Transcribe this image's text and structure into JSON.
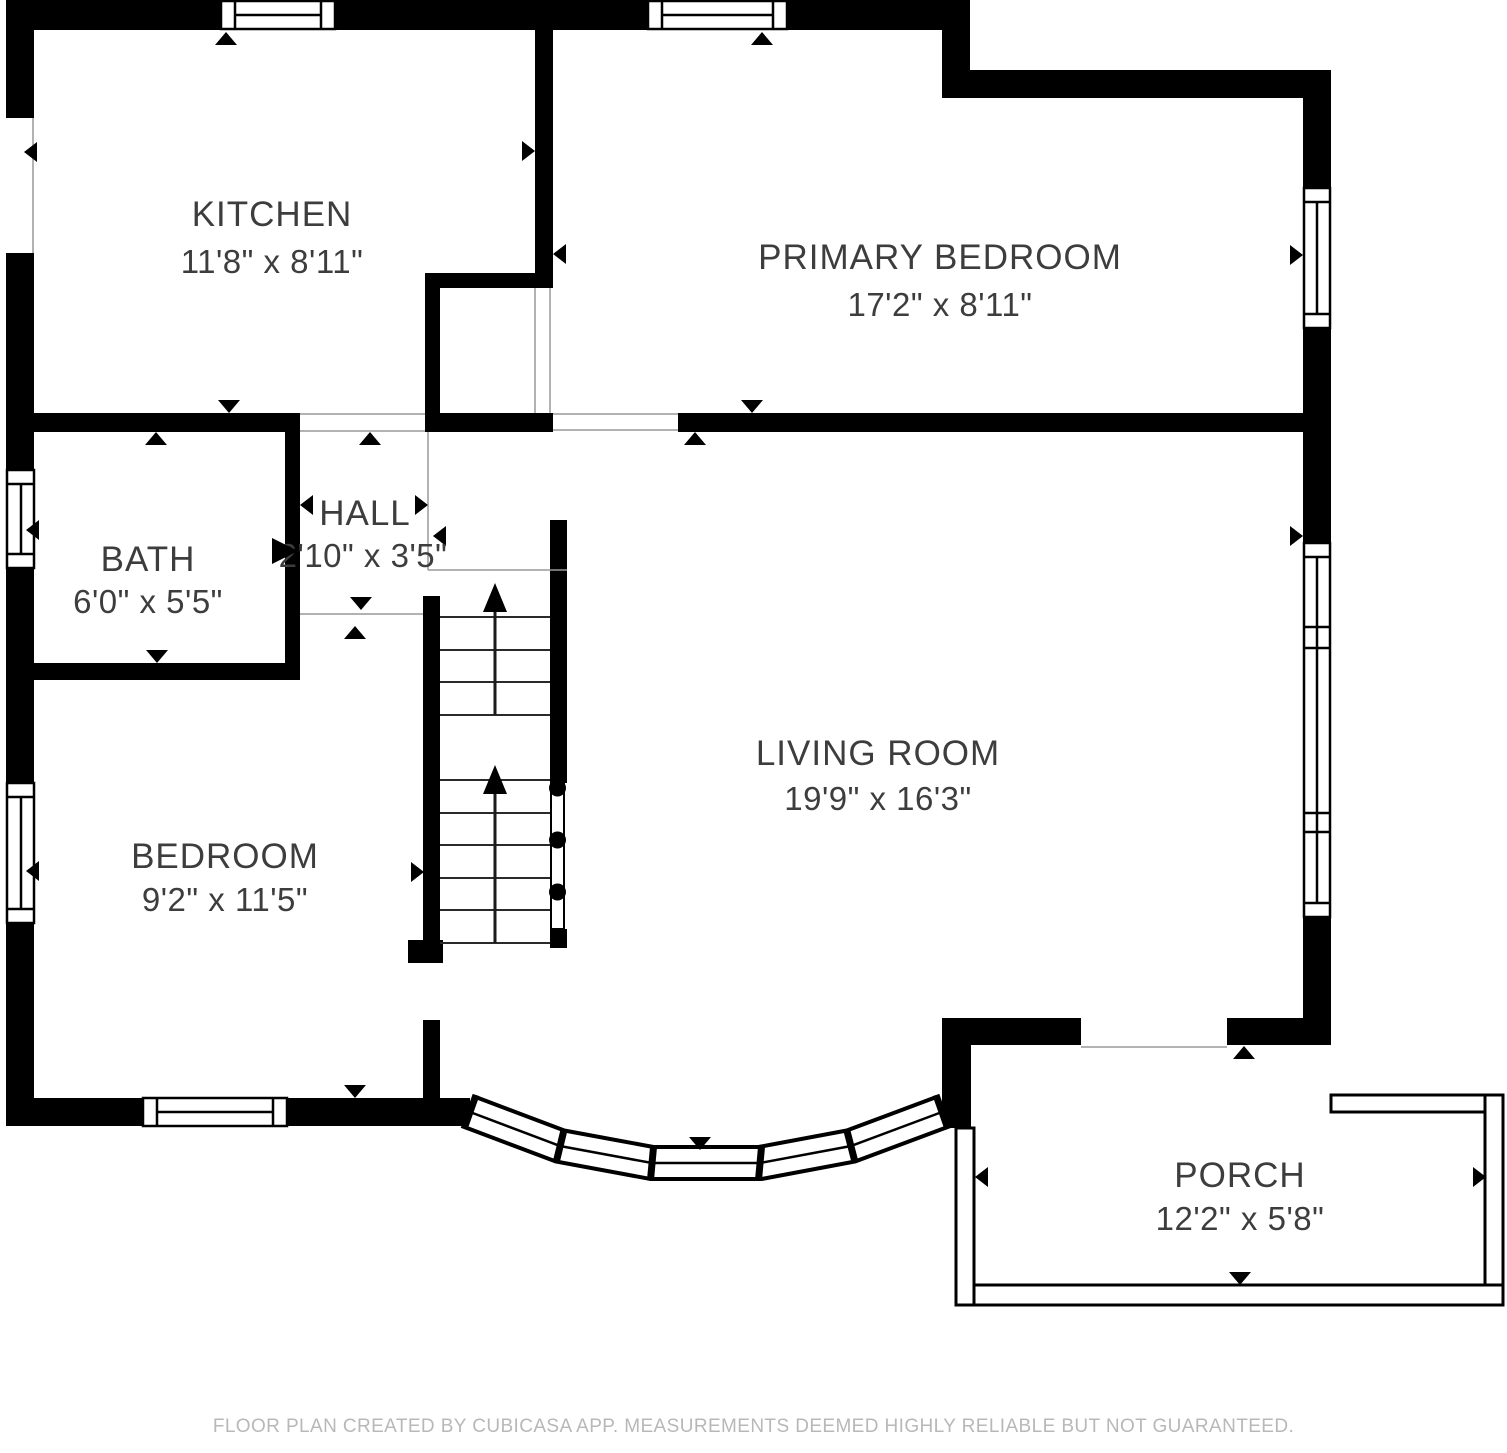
{
  "plan": {
    "rooms": [
      {
        "name": "KITCHEN",
        "dimensions": "11'8\" x 8'11\""
      },
      {
        "name": "PRIMARY BEDROOM",
        "dimensions": "17'2\" x 8'11\""
      },
      {
        "name": "HALL",
        "dimensions": "2'10\" x 3'5\""
      },
      {
        "name": "BATH",
        "dimensions": "6'0\" x 5'5\""
      },
      {
        "name": "BEDROOM",
        "dimensions": "9'2\" x 11'5\""
      },
      {
        "name": "LIVING ROOM",
        "dimensions": "19'9\" x 16'3\""
      },
      {
        "name": "PORCH",
        "dimensions": "12'2\" x 5'8\""
      }
    ],
    "features": [
      "staircase-up",
      "bay-window",
      "porch-railing",
      "door-opening-arrows",
      "window-glyphs"
    ]
  },
  "footer": {
    "text": "FLOOR PLAN CREATED BY CUBICASA APP. MEASUREMENTS DEEMED HIGHLY RELIABLE BUT NOT GUARANTEED."
  },
  "colors": {
    "wall": "#000000",
    "room_text": "#3d3d3d",
    "footer_text": "#b8b8b8",
    "thin_line": "#999999",
    "background": "#ffffff"
  }
}
